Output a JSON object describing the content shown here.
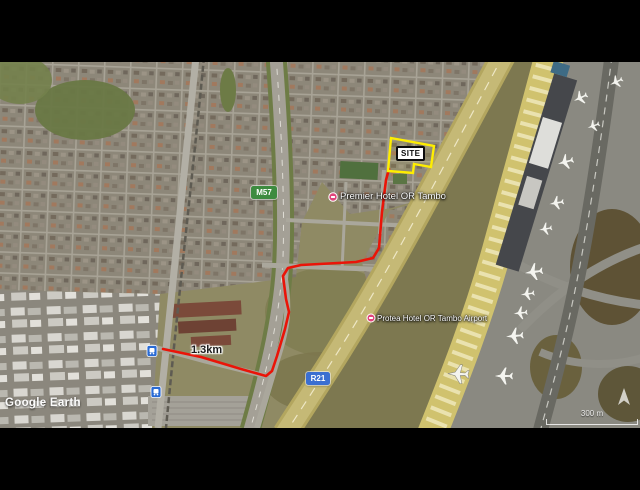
{
  "map": {
    "attribution": "Google Earth",
    "site": {
      "label": "SITE",
      "outline_color": "#ffee00"
    },
    "route": {
      "distance_label": "1.3km",
      "color": "#ea1408"
    },
    "shields": {
      "m57": {
        "label": "M57",
        "color": "#3d8b40"
      },
      "r21": {
        "label": "R21",
        "color": "#3b6fd1"
      }
    },
    "places": {
      "premier": {
        "name": "Premier Hotel OR Tambo"
      },
      "protea": {
        "name": "Protea Hotel OR Tambo Airport"
      }
    },
    "pin_color": "#e0457b",
    "transit_icon_color": "#2a6bd4",
    "scale": {
      "label": "300 m"
    }
  }
}
